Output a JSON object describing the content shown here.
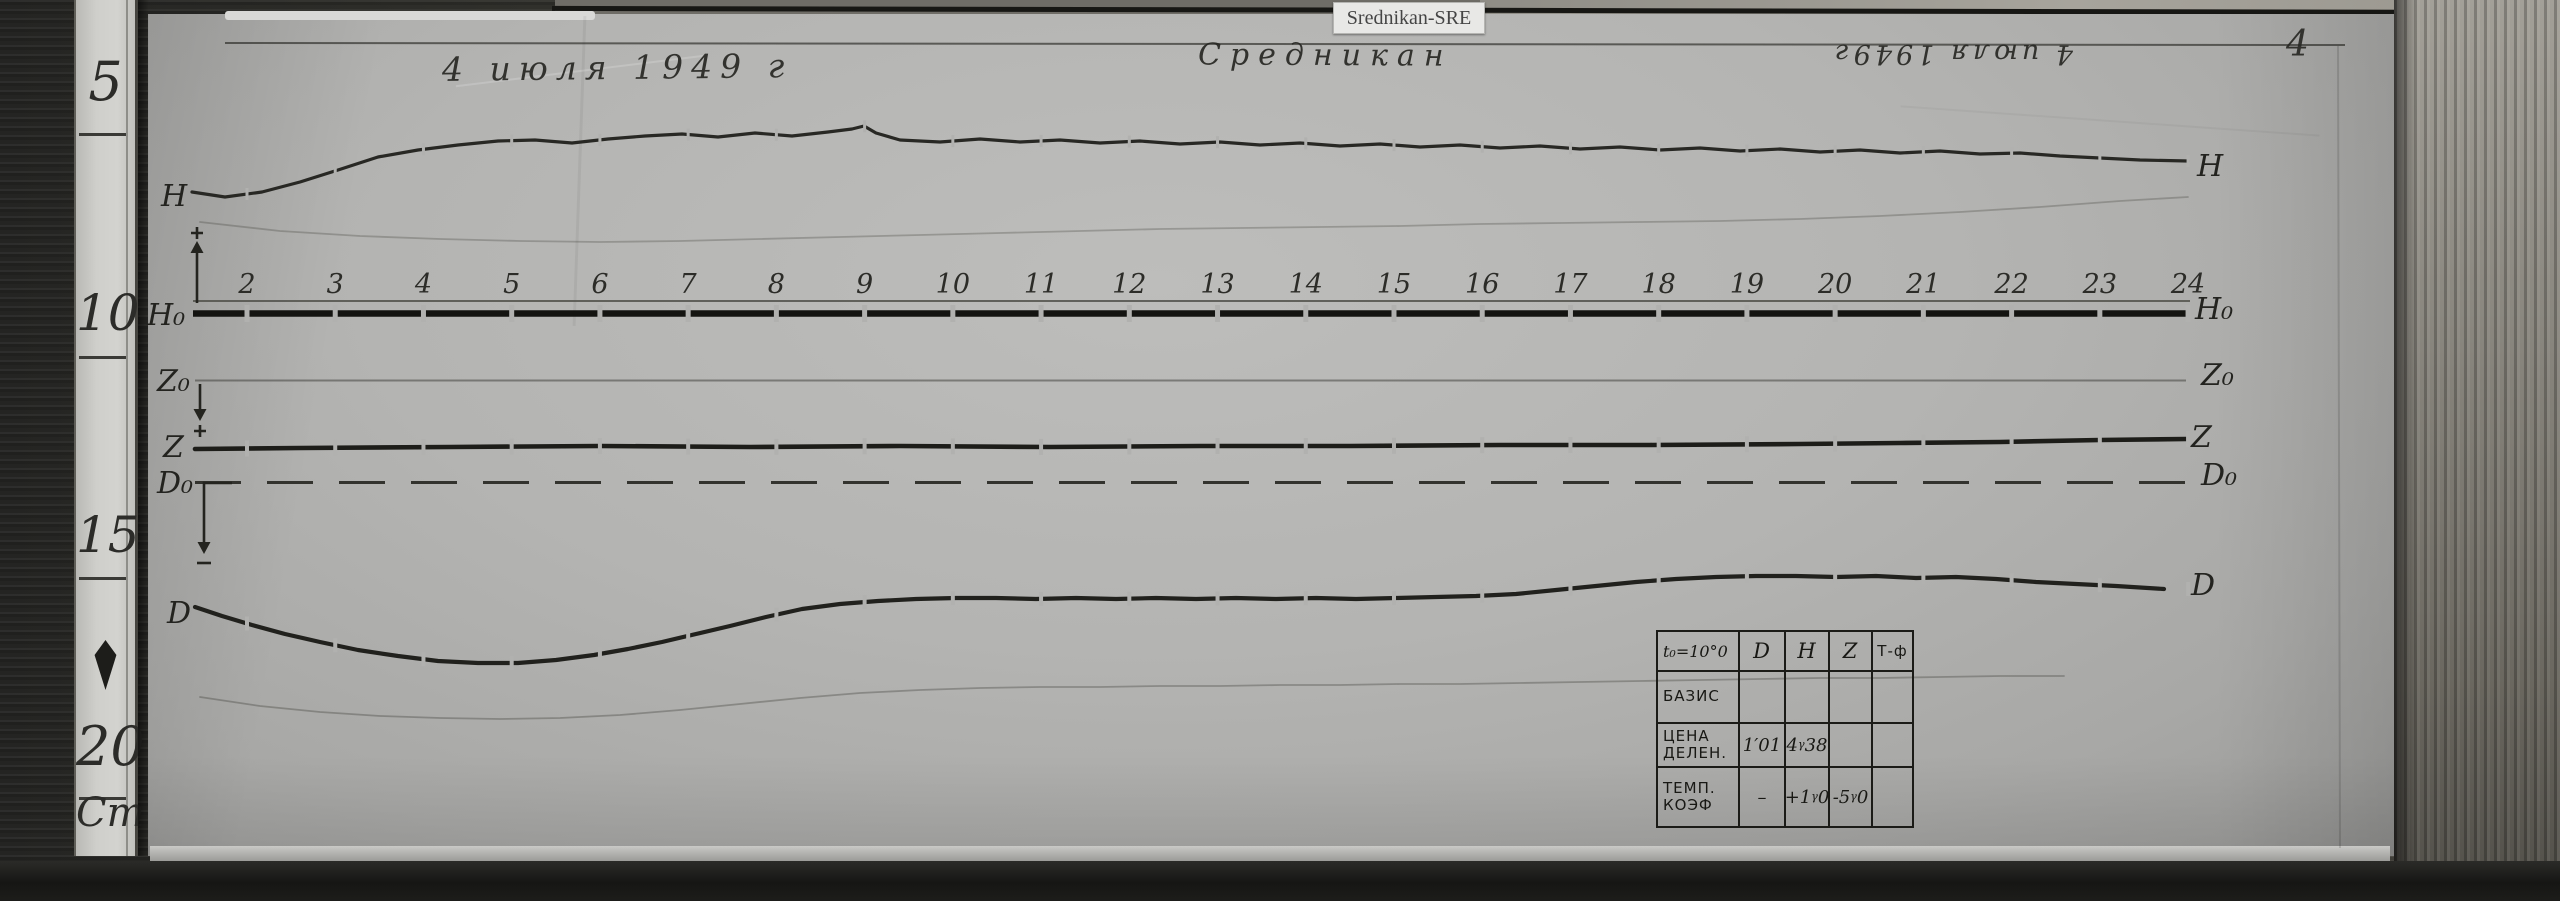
{
  "label_tag": "Srednikan-SRE",
  "inscriptions": {
    "date_left": "4 июля 1949 г",
    "station": "Средникан",
    "date_right": "4 июля 1949г",
    "sheet_number": "4"
  },
  "ruler": {
    "marks": [
      "5",
      "10",
      "15",
      "20"
    ],
    "unit": "Cm"
  },
  "chart_data": {
    "type": "line",
    "hours": [
      "2",
      "3",
      "4",
      "5",
      "6",
      "7",
      "8",
      "9",
      "10",
      "11",
      "12",
      "13",
      "14",
      "15",
      "16",
      "17",
      "18",
      "19",
      "20",
      "21",
      "22",
      "23",
      "24"
    ],
    "trace_labels": [
      "H",
      "H₀",
      "Z₀",
      "Z",
      "D₀",
      "D"
    ],
    "curves": {
      "h": [
        [
          192,
          192
        ],
        [
          225,
          197
        ],
        [
          262,
          192
        ],
        [
          300,
          182
        ],
        [
          338,
          170
        ],
        [
          378,
          157
        ],
        [
          418,
          150
        ],
        [
          458,
          145
        ],
        [
          498,
          141
        ],
        [
          535,
          140
        ],
        [
          572,
          143
        ],
        [
          608,
          139
        ],
        [
          645,
          136
        ],
        [
          682,
          134
        ],
        [
          718,
          137
        ],
        [
          755,
          133
        ],
        [
          792,
          136
        ],
        [
          828,
          132
        ],
        [
          852,
          129
        ],
        [
          864,
          126
        ],
        [
          876,
          133
        ],
        [
          900,
          140
        ],
        [
          940,
          142
        ],
        [
          980,
          139
        ],
        [
          1020,
          142
        ],
        [
          1060,
          140
        ],
        [
          1100,
          143
        ],
        [
          1140,
          141
        ],
        [
          1180,
          144
        ],
        [
          1220,
          142
        ],
        [
          1260,
          145
        ],
        [
          1300,
          143
        ],
        [
          1340,
          146
        ],
        [
          1380,
          144
        ],
        [
          1420,
          147
        ],
        [
          1460,
          145
        ],
        [
          1500,
          148
        ],
        [
          1540,
          146
        ],
        [
          1580,
          149
        ],
        [
          1620,
          147
        ],
        [
          1660,
          150
        ],
        [
          1700,
          148
        ],
        [
          1740,
          151
        ],
        [
          1780,
          149
        ],
        [
          1820,
          152
        ],
        [
          1860,
          150
        ],
        [
          1900,
          153
        ],
        [
          1940,
          151
        ],
        [
          1980,
          154
        ],
        [
          2020,
          153
        ],
        [
          2060,
          156
        ],
        [
          2100,
          158
        ],
        [
          2140,
          160
        ],
        [
          2188,
          161
        ]
      ],
      "z": [
        [
          195,
          449
        ],
        [
          300,
          448
        ],
        [
          450,
          447
        ],
        [
          600,
          446
        ],
        [
          750,
          447
        ],
        [
          900,
          446
        ],
        [
          1050,
          447
        ],
        [
          1200,
          446
        ],
        [
          1350,
          446
        ],
        [
          1500,
          445
        ],
        [
          1650,
          445
        ],
        [
          1800,
          444
        ],
        [
          1900,
          443
        ],
        [
          2000,
          442
        ],
        [
          2100,
          440
        ],
        [
          2186,
          439
        ]
      ],
      "d": [
        [
          195,
          607
        ],
        [
          222,
          616
        ],
        [
          252,
          625
        ],
        [
          285,
          634
        ],
        [
          320,
          642
        ],
        [
          358,
          650
        ],
        [
          398,
          656
        ],
        [
          438,
          661
        ],
        [
          478,
          663
        ],
        [
          518,
          663
        ],
        [
          556,
          660
        ],
        [
          594,
          655
        ],
        [
          628,
          649
        ],
        [
          662,
          642
        ],
        [
          696,
          634
        ],
        [
          730,
          626
        ],
        [
          766,
          617
        ],
        [
          802,
          609
        ],
        [
          840,
          604
        ],
        [
          878,
          601
        ],
        [
          916,
          599
        ],
        [
          956,
          598
        ],
        [
          996,
          598
        ],
        [
          1036,
          599
        ],
        [
          1076,
          598
        ],
        [
          1116,
          599
        ],
        [
          1156,
          598
        ],
        [
          1196,
          599
        ],
        [
          1236,
          598
        ],
        [
          1276,
          599
        ],
        [
          1316,
          598
        ],
        [
          1356,
          599
        ],
        [
          1396,
          598
        ],
        [
          1436,
          597
        ],
        [
          1476,
          596
        ],
        [
          1516,
          594
        ],
        [
          1556,
          590
        ],
        [
          1596,
          586
        ],
        [
          1636,
          582
        ],
        [
          1676,
          579
        ],
        [
          1716,
          577
        ],
        [
          1756,
          576
        ],
        [
          1796,
          576
        ],
        [
          1836,
          577
        ],
        [
          1876,
          576
        ],
        [
          1916,
          578
        ],
        [
          1956,
          577
        ],
        [
          1996,
          579
        ],
        [
          2036,
          582
        ],
        [
          2076,
          584
        ],
        [
          2116,
          586
        ],
        [
          2164,
          589
        ]
      ],
      "faint_upper": [
        [
          200,
          222
        ],
        [
          280,
          231
        ],
        [
          360,
          236
        ],
        [
          440,
          239
        ],
        [
          520,
          241
        ],
        [
          600,
          242
        ],
        [
          680,
          241
        ],
        [
          760,
          239
        ],
        [
          840,
          237
        ],
        [
          920,
          235
        ],
        [
          1000,
          233
        ],
        [
          1080,
          231
        ],
        [
          1160,
          229
        ],
        [
          1240,
          228
        ],
        [
          1320,
          227
        ],
        [
          1400,
          226
        ],
        [
          1480,
          224
        ],
        [
          1560,
          223
        ],
        [
          1640,
          222
        ],
        [
          1720,
          221
        ],
        [
          1800,
          219
        ],
        [
          1880,
          216
        ],
        [
          1960,
          212
        ],
        [
          2040,
          207
        ],
        [
          2120,
          201
        ],
        [
          2188,
          197
        ]
      ],
      "faint_lower": [
        [
          200,
          697
        ],
        [
          260,
          706
        ],
        [
          320,
          712
        ],
        [
          380,
          716
        ],
        [
          440,
          718
        ],
        [
          500,
          719
        ],
        [
          560,
          718
        ],
        [
          620,
          715
        ],
        [
          680,
          710
        ],
        [
          740,
          704
        ],
        [
          800,
          698
        ],
        [
          860,
          693
        ],
        [
          920,
          690
        ],
        [
          980,
          688
        ],
        [
          1040,
          687
        ],
        [
          1100,
          687
        ],
        [
          1160,
          686
        ],
        [
          1220,
          686
        ],
        [
          1280,
          685
        ],
        [
          1340,
          685
        ],
        [
          1400,
          684
        ],
        [
          1460,
          684
        ],
        [
          1520,
          683
        ],
        [
          1580,
          682
        ],
        [
          1640,
          681
        ],
        [
          1700,
          680
        ],
        [
          1760,
          679
        ],
        [
          1820,
          678
        ],
        [
          1880,
          678
        ],
        [
          1940,
          677
        ],
        [
          2000,
          676
        ],
        [
          2064,
          676
        ]
      ]
    }
  },
  "table": {
    "header": [
      "t₀=10°0",
      "D",
      "H",
      "Z",
      "Т-ф"
    ],
    "rows": [
      [
        "БАЗИС",
        "",
        "",
        "",
        ""
      ],
      [
        "ЦЕНА\nДЕЛЕН.",
        "1′01",
        "4γ38",
        "",
        ""
      ],
      [
        "ТЕМП.\nКОЭФ",
        "–",
        "+1γ0",
        "-5γ0",
        ""
      ]
    ]
  }
}
